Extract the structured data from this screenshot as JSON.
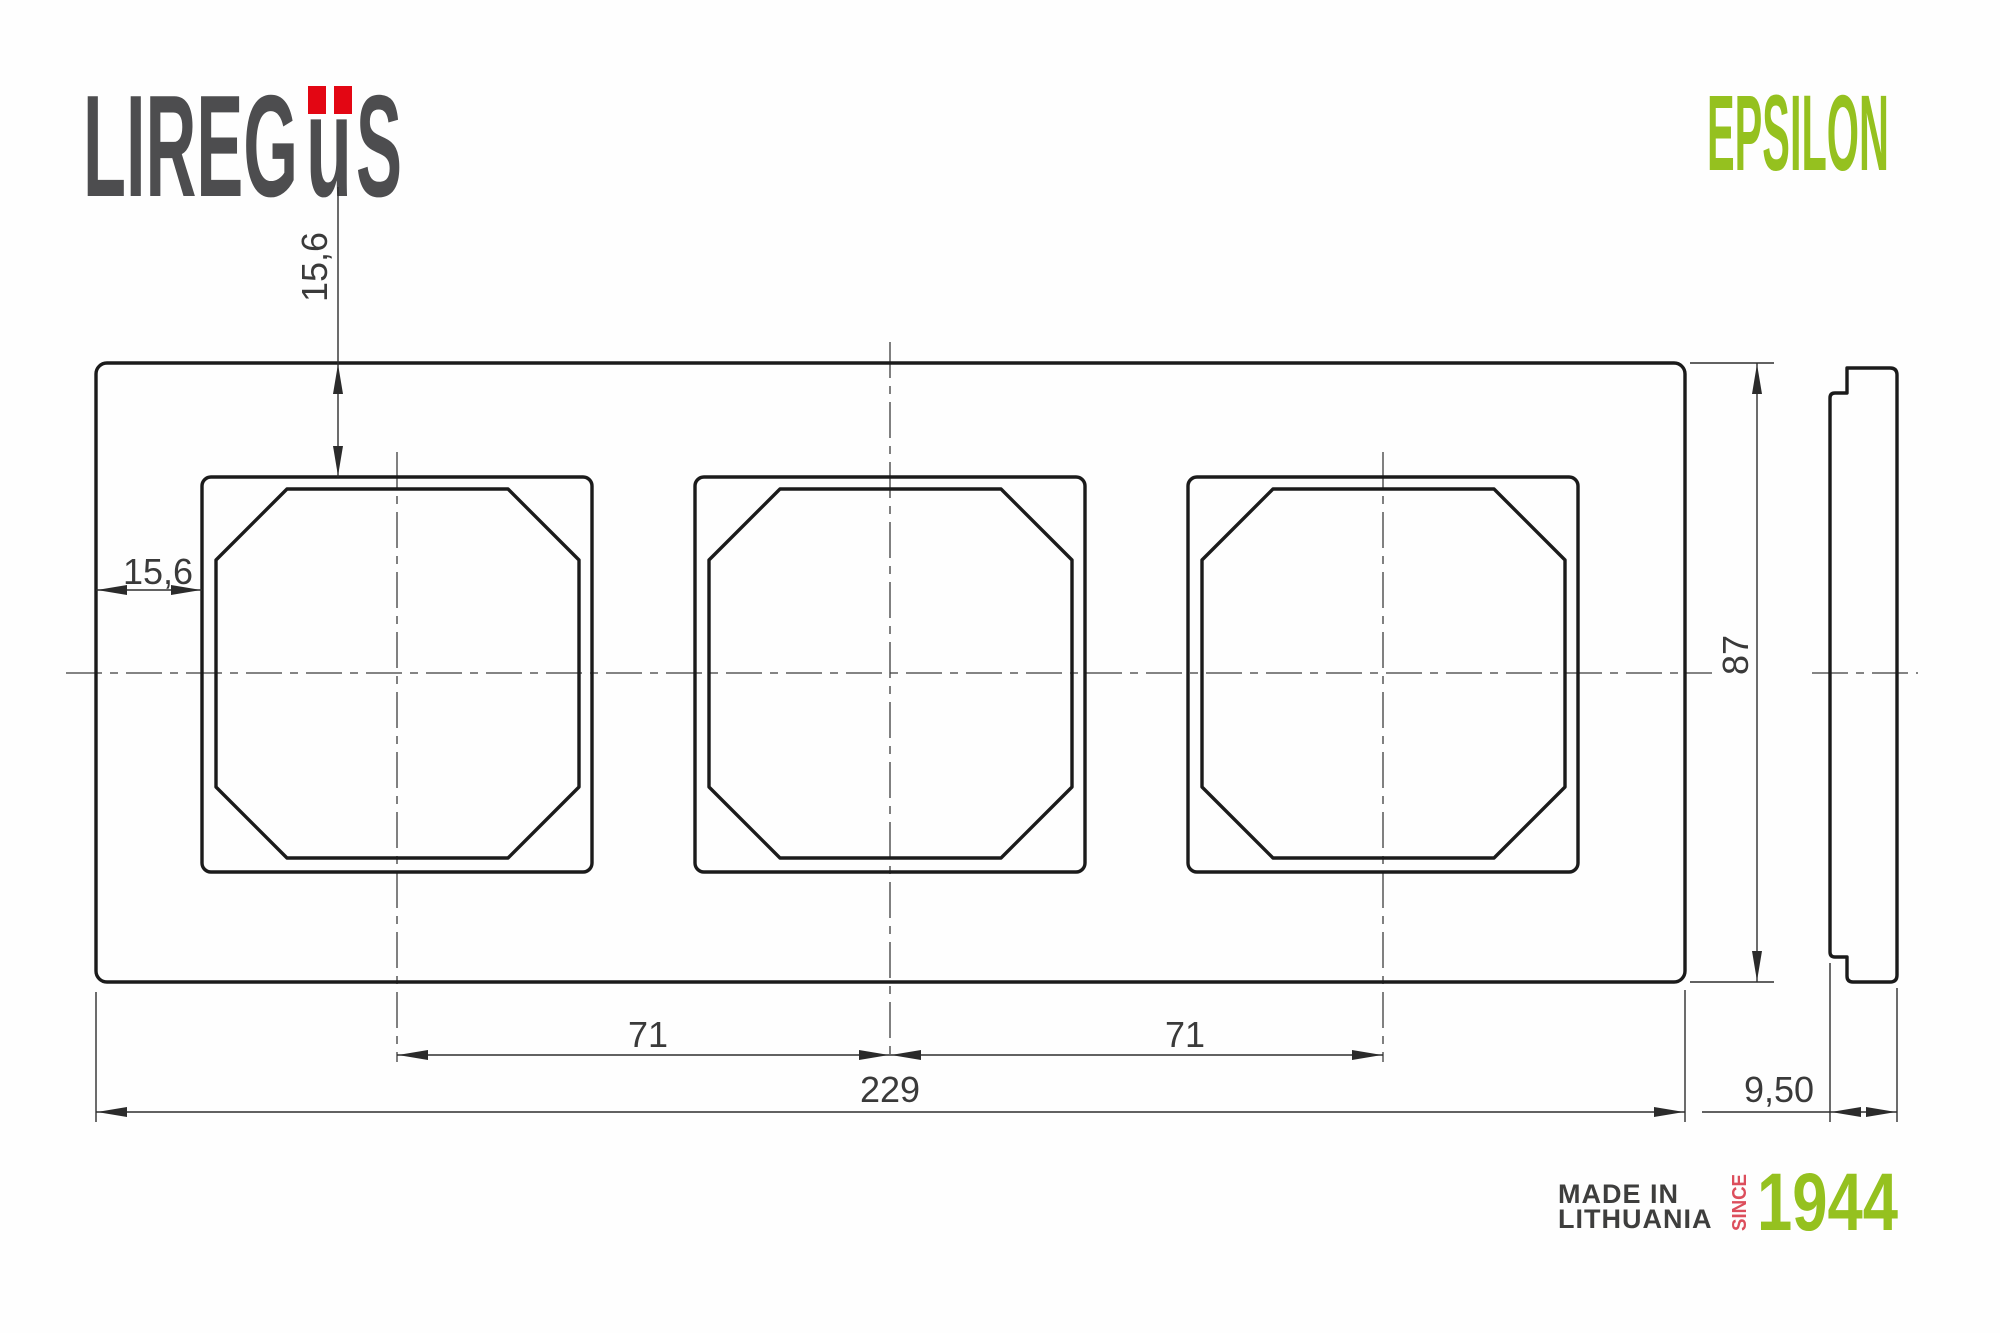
{
  "brand": {
    "logo_part1": "LIREG",
    "logo_part2": "u",
    "logo_part3": "S",
    "logo_color": "#4D4D4F",
    "umlaut_color": "#E30613",
    "series_name": "EPSILON",
    "series_color": "#95C11F"
  },
  "drawing": {
    "title": "3-gang frame dimensional drawing",
    "dimensions": {
      "top_offset": "15,6",
      "left_offset": "15,6",
      "pitch_left": "71",
      "pitch_right": "71",
      "total_width": "229",
      "total_height": "87",
      "depth": "9,50"
    }
  },
  "footer": {
    "made_in_line1": "MADE IN",
    "made_in_line2": "LITHUANIA",
    "since_label": "SINCE",
    "since_year": "1944",
    "since_color": "#DC4E5C",
    "year_color": "#95C11F"
  }
}
